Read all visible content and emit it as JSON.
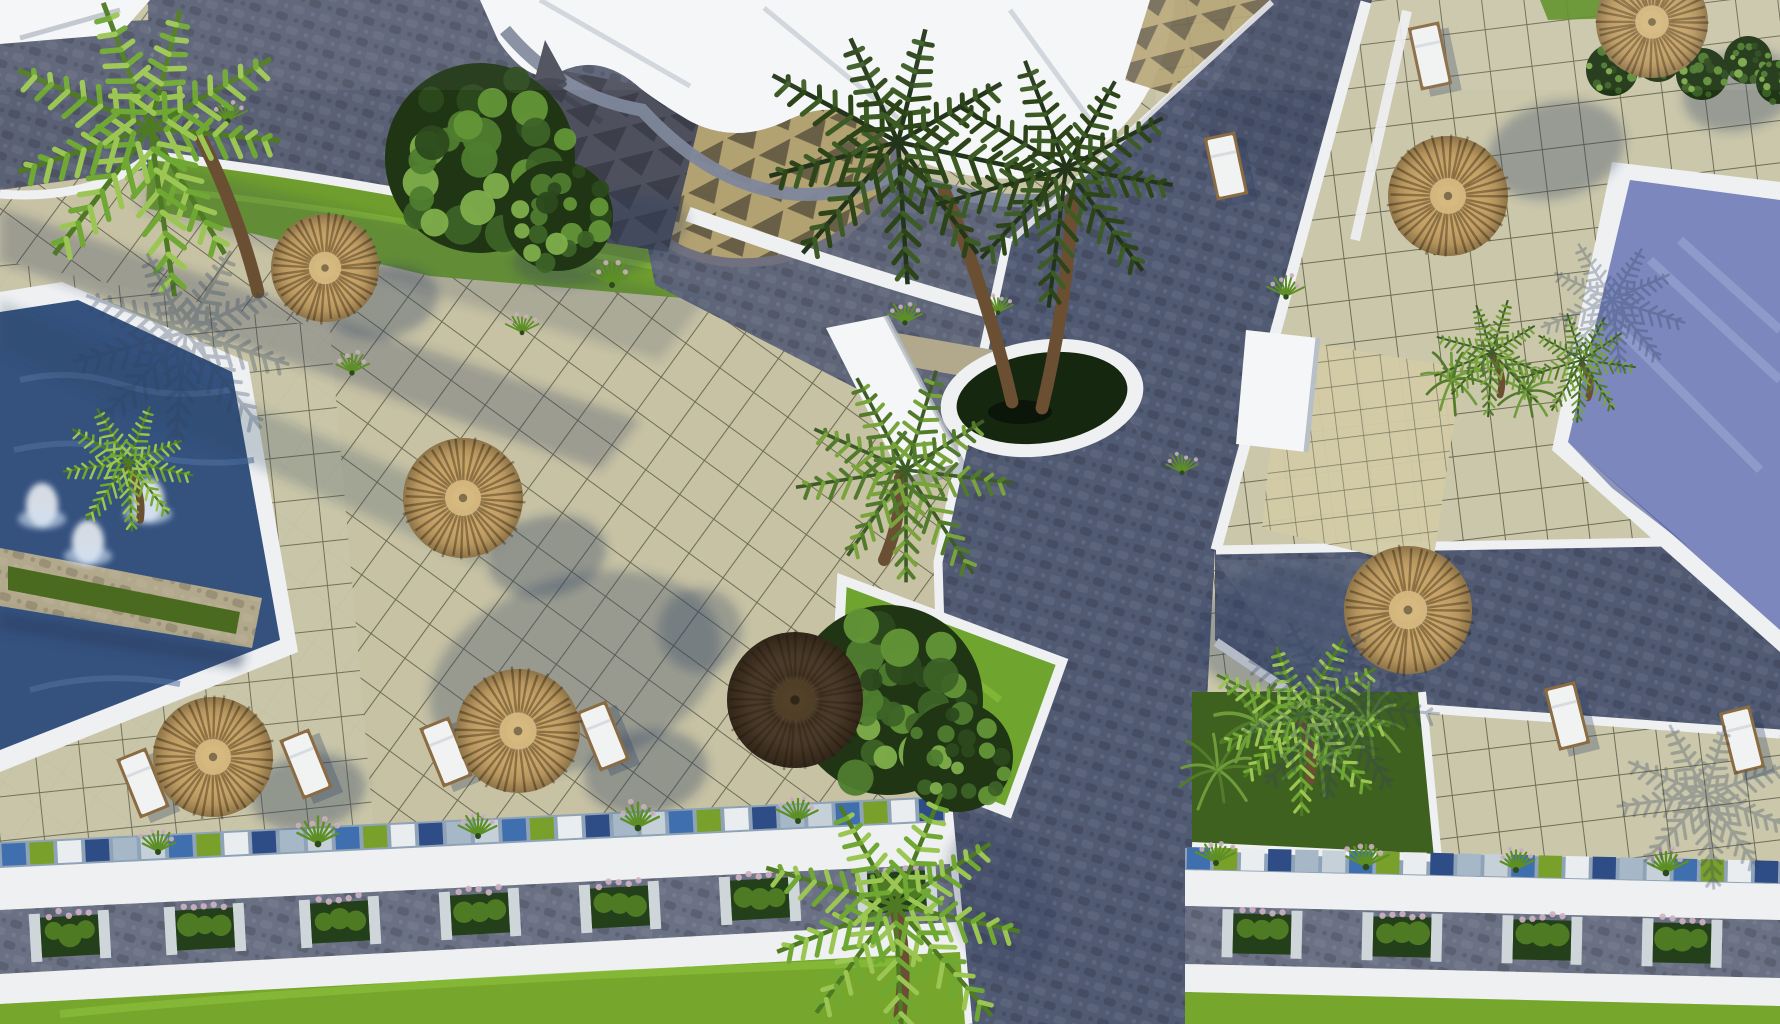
{
  "scene": {
    "kind": "aerial-3d-architectural-render",
    "description": "Top-down rendering of a resort: tiled sun terraces with thatched parasols and white sun loungers, two deep-blue pools with a planted stone divider and fountain jets on the left, a periwinkle pool upper right, a white clubhouse roof at top, dark cobbled roads crossing the site, planter-lined promenades and bright lawns along the bottom, palm trees and bushes throughout.",
    "objects": [
      "swimming-pool",
      "thatched-parasol",
      "sun-lounger",
      "palm-tree",
      "bush",
      "fern",
      "planter-box",
      "ornamental-grass",
      "road",
      "tiled-terrace",
      "clubhouse-roof",
      "lawn",
      "fountain",
      "footbridge",
      "circular-planter"
    ]
  },
  "palette": {
    "tile_base": "#c7c2a4",
    "tile_right": "#cbc7ab",
    "tile_small": "#d2cba6",
    "grout": "#6f6d57",
    "road": "#515a73",
    "road_dark": "#2e3850",
    "road_light": "#6a7288",
    "cobble_blue": "#5a6175",
    "curb_white": "#eef0f2",
    "roof_white": "#f4f6f7",
    "gray_band": "#7e879b",
    "pattern_dark": "#4e505e",
    "tri_tan": "#b3a271",
    "tri_dark": "#5c5340",
    "water_left": "#35527f",
    "water_left_light": "#50719f",
    "water_right": "#7b87bd",
    "water_right_light": "#97a2cf",
    "water_right_dark": "#4d5a91",
    "lawn": "#76a62c",
    "lawn_light": "#8cbf3a",
    "lawn_dark": "#3f6120",
    "planter_grass": "#4a6b1f",
    "planter_soil": "#16270f",
    "stone": "#b2a88b",
    "walkway": "#6a7184",
    "thatch": "#c9a466",
    "thatch_dark": "#463625",
    "trunk": "#6b4f33",
    "shadow": "#2b3e5f",
    "flower_pink": "#cfb3c3",
    "mosaic": [
      "#3f6fae",
      "#7aa02c",
      "#e9edf0",
      "#2e4d86",
      "#a6b7c8",
      "#c5d0d8"
    ]
  },
  "umbrellas": [
    {
      "x": 325,
      "y": 268,
      "r": 54,
      "v": "tan"
    },
    {
      "x": 463,
      "y": 498,
      "r": 60,
      "v": "tan"
    },
    {
      "x": 518,
      "y": 731,
      "r": 62,
      "v": "tan"
    },
    {
      "x": 213,
      "y": 757,
      "r": 60,
      "v": "tan"
    },
    {
      "x": 795,
      "y": 700,
      "r": 68,
      "v": "dark"
    },
    {
      "x": 1448,
      "y": 196,
      "r": 60,
      "v": "tan"
    },
    {
      "x": 1652,
      "y": 22,
      "r": 56,
      "v": "tan"
    },
    {
      "x": 1408,
      "y": 610,
      "r": 64,
      "v": "tan"
    }
  ],
  "loungers": [
    {
      "x": 143,
      "y": 783,
      "a": -22
    },
    {
      "x": 306,
      "y": 764,
      "a": -22
    },
    {
      "x": 446,
      "y": 752,
      "a": -22
    },
    {
      "x": 603,
      "y": 736,
      "a": -22
    },
    {
      "x": 756,
      "y": 714,
      "a": -22
    },
    {
      "x": 1226,
      "y": 166,
      "a": -12
    },
    {
      "x": 1430,
      "y": 56,
      "a": -12
    },
    {
      "x": 1567,
      "y": 716,
      "a": -14
    },
    {
      "x": 1742,
      "y": 740,
      "a": -14
    }
  ],
  "planter_boxes": [
    {
      "x": 70,
      "y": 936,
      "a": -3.2
    },
    {
      "x": 205,
      "y": 929,
      "a": -3.2
    },
    {
      "x": 340,
      "y": 922,
      "a": -3.2
    },
    {
      "x": 480,
      "y": 914,
      "a": -3.2
    },
    {
      "x": 620,
      "y": 907,
      "a": -3.2
    },
    {
      "x": 760,
      "y": 899,
      "a": -3.2
    },
    {
      "x": 897,
      "y": 892,
      "a": -3.2
    },
    {
      "x": 1262,
      "y": 934,
      "a": 1.3
    },
    {
      "x": 1402,
      "y": 937,
      "a": 1.3
    },
    {
      "x": 1542,
      "y": 940,
      "a": 1.3
    },
    {
      "x": 1682,
      "y": 943,
      "a": 1.3
    }
  ],
  "grass_tufts": [
    {
      "x": 158,
      "y": 851,
      "s": 1.0
    },
    {
      "x": 318,
      "y": 843,
      "s": 1.1
    },
    {
      "x": 478,
      "y": 835,
      "s": 1.0
    },
    {
      "x": 638,
      "y": 827,
      "s": 1.1
    },
    {
      "x": 798,
      "y": 820,
      "s": 1.0
    },
    {
      "x": 1216,
      "y": 862,
      "s": 1.0
    },
    {
      "x": 1366,
      "y": 866,
      "s": 1.1
    },
    {
      "x": 1516,
      "y": 869,
      "s": 1.0
    },
    {
      "x": 1666,
      "y": 872,
      "s": 1.1
    },
    {
      "x": 228,
      "y": 120,
      "s": 0.9
    },
    {
      "x": 612,
      "y": 284,
      "s": 1.0
    },
    {
      "x": 905,
      "y": 322,
      "s": 0.9
    },
    {
      "x": 998,
      "y": 312,
      "s": 0.8
    },
    {
      "x": 1286,
      "y": 296,
      "s": 0.9
    },
    {
      "x": 352,
      "y": 372,
      "s": 0.9
    },
    {
      "x": 522,
      "y": 332,
      "s": 0.8
    },
    {
      "x": 1435,
      "y": 252,
      "s": 0.8
    },
    {
      "x": 1182,
      "y": 472,
      "s": 0.8
    }
  ],
  "palms": [
    {
      "x": 150,
      "y": 128,
      "s": 2.1,
      "v": "bright",
      "trunk": [
        258,
        292,
        200,
        136
      ]
    },
    {
      "x": 898,
      "y": 142,
      "s": 1.9,
      "v": "dark",
      "trunk": [
        1012,
        402,
        944,
        190
      ]
    },
    {
      "x": 1066,
      "y": 168,
      "s": 1.7,
      "v": "dark",
      "trunk": [
        1042,
        408,
        1072,
        200
      ]
    },
    {
      "x": 906,
      "y": 470,
      "s": 1.5,
      "v": "mid",
      "trunk": [
        884,
        560,
        900,
        478
      ]
    },
    {
      "x": 895,
      "y": 905,
      "s": 1.85,
      "v": "bright",
      "trunk": [
        900,
        1015,
        896,
        910
      ]
    },
    {
      "x": 128,
      "y": 462,
      "s": 0.95,
      "v": "bright",
      "trunk": [
        140,
        520,
        128,
        468
      ]
    },
    {
      "x": 1300,
      "y": 716,
      "s": 1.25,
      "v": "bright",
      "trunk": [
        1310,
        780,
        1300,
        720
      ]
    },
    {
      "x": 1492,
      "y": 352,
      "s": 0.85,
      "v": "mid",
      "trunk": [
        1500,
        395,
        1492,
        356
      ]
    },
    {
      "x": 1582,
      "y": 360,
      "s": 0.8,
      "v": "mid",
      "trunk": [
        1588,
        398,
        1582,
        364
      ]
    },
    {
      "x": 186,
      "y": 332,
      "s": 1.5,
      "v": "shadow"
    },
    {
      "x": 1335,
      "y": 705,
      "s": 1.35,
      "v": "shadow"
    },
    {
      "x": 1612,
      "y": 300,
      "s": 1.0,
      "v": "shadow"
    },
    {
      "x": 1706,
      "y": 795,
      "s": 1.25,
      "v": "shadow"
    }
  ],
  "ferns": [
    {
      "x": 1258,
      "y": 722,
      "s": 1.2
    },
    {
      "x": 1320,
      "y": 760,
      "s": 1.1
    },
    {
      "x": 1218,
      "y": 770,
      "s": 1.0
    },
    {
      "x": 1368,
      "y": 722,
      "s": 1.0
    },
    {
      "x": 1452,
      "y": 380,
      "s": 0.9
    },
    {
      "x": 1526,
      "y": 392,
      "s": 0.85
    }
  ],
  "bushes": [
    {
      "x": 480,
      "y": 158,
      "r": 95
    },
    {
      "x": 558,
      "y": 216,
      "r": 55
    },
    {
      "x": 888,
      "y": 700,
      "r": 95
    },
    {
      "x": 958,
      "y": 757,
      "r": 55
    },
    {
      "x": 1612,
      "y": 70,
      "r": 26
    },
    {
      "x": 1658,
      "y": 58,
      "r": 24
    },
    {
      "x": 1702,
      "y": 74,
      "r": 26
    },
    {
      "x": 1748,
      "y": 60,
      "r": 24
    },
    {
      "x": 1778,
      "y": 82,
      "r": 22
    }
  ],
  "fountains": [
    {
      "x": 42,
      "y": 505
    },
    {
      "x": 148,
      "y": 500
    },
    {
      "x": 88,
      "y": 542
    }
  ],
  "shadows": {
    "ellipses": [
      {
        "x": 383,
        "y": 302,
        "rx": 56,
        "ry": 36,
        "rot": -12,
        "o": 0.34
      },
      {
        "x": 547,
        "y": 556,
        "rx": 60,
        "ry": 40,
        "rot": -12,
        "o": 0.34
      },
      {
        "x": 646,
        "y": 772,
        "rx": 62,
        "ry": 42,
        "rot": -10,
        "o": 0.34
      },
      {
        "x": 308,
        "y": 792,
        "rx": 58,
        "ry": 38,
        "rot": -10,
        "o": 0.34
      },
      {
        "x": 575,
        "y": 672,
        "rx": 150,
        "ry": 95,
        "rot": -18,
        "o": 0.3
      },
      {
        "x": 700,
        "y": 630,
        "rx": 42,
        "ry": 42,
        "rot": 0,
        "o": 0.3
      },
      {
        "x": 1556,
        "y": 150,
        "rx": 70,
        "ry": 48,
        "rot": -15,
        "o": 0.32
      },
      {
        "x": 1740,
        "y": 90,
        "rx": 58,
        "ry": 40,
        "rot": -15,
        "o": 0.32
      },
      {
        "x": 1282,
        "y": 630,
        "rx": 88,
        "ry": 62,
        "rot": -12,
        "o": 0.3
      },
      {
        "x": 600,
        "y": 240,
        "rx": 90,
        "ry": 40,
        "rot": -16,
        "o": 0.3
      },
      {
        "x": 1000,
        "y": 900,
        "rx": 80,
        "ry": 50,
        "rot": 70,
        "o": 0.25
      }
    ],
    "polys": [
      {
        "pts": "0,208 640,420 600,470 0,262",
        "o": 0.28
      },
      {
        "pts": "0,300 520,520 480,566 0,352",
        "o": 0.22
      },
      {
        "pts": "150,160 705,300 660,360 140,210",
        "o": 0.18
      },
      {
        "pts": "0,612 246,652 240,668 0,630",
        "o": 0.5
      }
    ]
  },
  "mosaic_bands": [
    {
      "x1": 0,
      "y1": 855,
      "x2": 945,
      "y2": 809,
      "h": 22,
      "n": 34
    },
    {
      "x1": 1185,
      "y1": 858,
      "x2": 1780,
      "y2": 872,
      "h": 22,
      "n": 22
    }
  ]
}
